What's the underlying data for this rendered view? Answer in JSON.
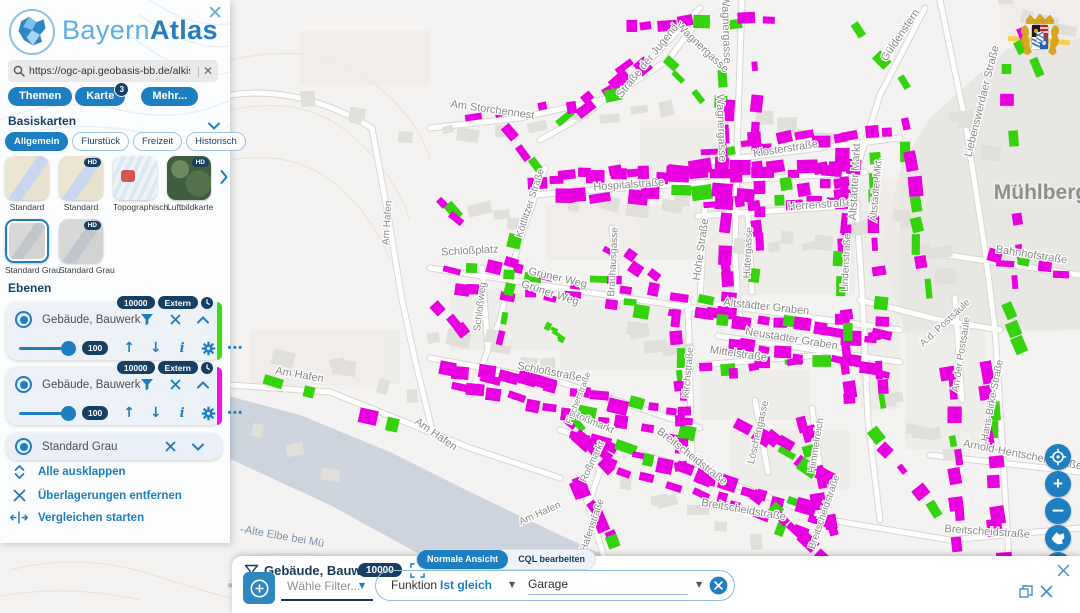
{
  "sidebar": {
    "close_icon": "✕",
    "logo": {
      "part1": "Bayern",
      "part2": "Atlas"
    },
    "search": {
      "value": "https://ogc-api.geobasis-bb.de/alkis-verein",
      "clear": "✕"
    },
    "menu": [
      {
        "label": "Themen"
      },
      {
        "label": "Karte",
        "badge": "3"
      },
      {
        "label": "Mehr..."
      }
    ],
    "basiskarten": {
      "header": "Basiskarten",
      "hd_label": "HD",
      "tabs": [
        {
          "label": "Allgemein",
          "active": true
        },
        {
          "label": "Flurstück",
          "active": false
        },
        {
          "label": "Freizeit",
          "active": false
        },
        {
          "label": "Historisch",
          "active": false
        }
      ],
      "thumbs": [
        {
          "label": "Standard",
          "style": "std",
          "hd": false,
          "selected": false
        },
        {
          "label": "Standard",
          "style": "std",
          "hd": true,
          "selected": false
        },
        {
          "label": "Topographisch",
          "style": "topo",
          "hd": false,
          "selected": false
        },
        {
          "label": "Luftbildkarte",
          "style": "aerial",
          "hd": true,
          "selected": false
        },
        {
          "label": "Standard Grau",
          "style": "gray",
          "hd": false,
          "selected": true
        },
        {
          "label": "Standard Grau",
          "style": "gray",
          "hd": true,
          "selected": false
        }
      ]
    },
    "ebenen": {
      "header": "Ebenen",
      "cards": [
        {
          "title": "Gebäude, Bauwerk",
          "badges": [
            "10000",
            "Extern"
          ],
          "opacity": "100",
          "stripe": "#3edc12",
          "expanded": true
        },
        {
          "title": "Gebäude, Bauwerk",
          "badges": [
            "10000",
            "Extern"
          ],
          "opacity": "100",
          "stripe": "#f013e4",
          "expanded": true
        },
        {
          "title": "Standard Grau",
          "badges": [],
          "opacity": "",
          "stripe": "",
          "expanded": false
        }
      ]
    },
    "actions": [
      {
        "icon": "expand",
        "label": "Alle ausklappen"
      },
      {
        "icon": "remove",
        "label": "Überlagerungen entfernen"
      },
      {
        "icon": "compare",
        "label": "Vergleichen starten"
      }
    ]
  },
  "filter": {
    "title": "Gebäude, Bauwerk",
    "badge": "10000",
    "views": [
      {
        "label": "Normale Ansicht",
        "active": true
      },
      {
        "label": "CQL bearbeiten",
        "active": false
      }
    ],
    "choose": "Wähle Filter...",
    "attribute": "Funktion",
    "operator": "Ist gleich",
    "value": "Garage"
  },
  "map": {
    "region_label": "Mühlberg",
    "water_label": "Alte Elbe bei Mü",
    "water_arrow": "←",
    "controls": {
      "zoom_in": "+",
      "zoom_out": "−",
      "threed": "3D"
    },
    "colors": {
      "magenta": "#e900e1",
      "green": "#35d30e"
    },
    "street_labels": [
      {
        "t": "Wagnergasse",
        "x": 700,
        "y": 50,
        "r": 43,
        "s": 11
      },
      {
        "t": "Wagnergasse",
        "x": 723,
        "y": 30,
        "r": 88,
        "s": 11
      },
      {
        "t": "Wagnergasse",
        "x": 718,
        "y": 128,
        "r": 88,
        "s": 11
      },
      {
        "t": "Straße der Jugend",
        "x": 650,
        "y": 63,
        "r": -51,
        "s": 11
      },
      {
        "t": "Am Storchennest",
        "x": 492,
        "y": 113,
        "r": 8,
        "s": 11
      },
      {
        "t": "Güldenstern",
        "x": 903,
        "y": 37,
        "r": -56,
        "s": 11
      },
      {
        "t": "Klosterstraße",
        "x": 786,
        "y": 152,
        "r": -9,
        "s": 11
      },
      {
        "t": "Hospitalstraße",
        "x": 629,
        "y": 188,
        "r": -4,
        "s": 11
      },
      {
        "t": "Herrenstraße",
        "x": 820,
        "y": 208,
        "r": -4,
        "s": 11
      },
      {
        "t": "Altstädter Markt",
        "x": 858,
        "y": 182,
        "r": -87,
        "s": 11
      },
      {
        "t": "Altstädter Mkt.",
        "x": 879,
        "y": 190,
        "r": -85,
        "s": 10
      },
      {
        "t": "Hohe Straße",
        "x": 704,
        "y": 250,
        "r": -82,
        "s": 11
      },
      {
        "t": "Hütergasse",
        "x": 751,
        "y": 253,
        "r": -87,
        "s": 10
      },
      {
        "t": "Köttlitzer Straße",
        "x": 533,
        "y": 204,
        "r": -72,
        "s": 10
      },
      {
        "t": "Liebenswerdaer Straße",
        "x": 985,
        "y": 102,
        "r": -76,
        "s": 11
      },
      {
        "t": "Bahnhofstraße",
        "x": 1031,
        "y": 258,
        "r": 9,
        "s": 11
      },
      {
        "t": "Schloßplatz",
        "x": 470,
        "y": 254,
        "r": -3,
        "s": 11
      },
      {
        "t": "Grüner Weg",
        "x": 557,
        "y": 281,
        "r": 13,
        "s": 11
      },
      {
        "t": "Grüner Weg",
        "x": 549,
        "y": 296,
        "r": 18,
        "s": 11
      },
      {
        "t": "Schloßweg",
        "x": 483,
        "y": 307,
        "r": -83,
        "s": 10
      },
      {
        "t": "Brauhausgasse",
        "x": 616,
        "y": 262,
        "r": -87,
        "s": 10
      },
      {
        "t": "Altstädter Graben",
        "x": 766,
        "y": 310,
        "r": 6,
        "s": 11
      },
      {
        "t": "Neustädter Graben",
        "x": 791,
        "y": 342,
        "r": 9,
        "s": 11
      },
      {
        "t": "Mittelstraße",
        "x": 738,
        "y": 357,
        "r": 8,
        "s": 11
      },
      {
        "t": "Kirchstraße",
        "x": 691,
        "y": 373,
        "r": -85,
        "s": 10
      },
      {
        "t": "Schloßstraße",
        "x": 549,
        "y": 375,
        "r": 11,
        "s": 11
      },
      {
        "t": "Lindenstraße",
        "x": 849,
        "y": 263,
        "r": -87,
        "s": 10
      },
      {
        "t": "A.d. Postsäule",
        "x": 947,
        "y": 325,
        "r": -43,
        "s": 10
      },
      {
        "t": "An der Postsäule",
        "x": 964,
        "y": 355,
        "r": -81,
        "s": 10
      },
      {
        "t": "Hans-Birke-Straße",
        "x": 995,
        "y": 401,
        "r": -79,
        "s": 10
      },
      {
        "t": "Arnold-Hentschel-Straße",
        "x": 1022,
        "y": 458,
        "r": 11,
        "s": 11
      },
      {
        "t": "Breitscheidstraße",
        "x": 690,
        "y": 459,
        "r": 38,
        "s": 11
      },
      {
        "t": "Breitscheidstraße",
        "x": 743,
        "y": 513,
        "r": 10,
        "s": 11
      },
      {
        "t": "Breitscheidstraße",
        "x": 827,
        "y": 513,
        "r": -71,
        "s": 10
      },
      {
        "t": "Breitscheidstraße",
        "x": 987,
        "y": 535,
        "r": 4,
        "s": 11
      },
      {
        "t": "Löschengasse",
        "x": 761,
        "y": 433,
        "r": -77,
        "s": 10
      },
      {
        "t": "Himmelreich",
        "x": 819,
        "y": 446,
        "r": -81,
        "s": 10
      },
      {
        "t": "Roßmarkt",
        "x": 592,
        "y": 425,
        "r": 23,
        "s": 10
      },
      {
        "t": "Roßmarkt",
        "x": 595,
        "y": 463,
        "r": -65,
        "s": 10
      },
      {
        "t": "Fischerstraße",
        "x": 581,
        "y": 399,
        "r": -69,
        "s": 9
      },
      {
        "t": "Hafenstraße",
        "x": 595,
        "y": 526,
        "r": -71,
        "s": 10
      },
      {
        "t": "Am Hafen",
        "x": 390,
        "y": 223,
        "r": -86,
        "s": 10
      },
      {
        "t": "Am Hafen",
        "x": 299,
        "y": 378,
        "r": 10,
        "s": 11
      },
      {
        "t": "Am Hafen",
        "x": 434,
        "y": 437,
        "r": 35,
        "s": 11
      },
      {
        "t": "Am Hafen",
        "x": 541,
        "y": 516,
        "r": -24,
        "s": 10
      }
    ],
    "building_rows": [
      [
        540,
        178,
        862,
        166,
        26,
        13,
        0.14
      ],
      [
        546,
        197,
        858,
        187,
        13,
        12,
        0.2
      ],
      [
        700,
        151,
        893,
        130,
        12,
        11,
        0.12
      ],
      [
        703,
        207,
        851,
        198,
        9,
        11,
        0.15
      ],
      [
        724,
        72,
        727,
        290,
        12,
        12,
        0.15
      ],
      [
        754,
        64,
        757,
        285,
        10,
        11,
        0.2
      ],
      [
        628,
        26,
        772,
        18,
        8,
        11,
        0.22
      ],
      [
        560,
        120,
        648,
        58,
        7,
        12,
        0.2
      ],
      [
        440,
        264,
        730,
        300,
        14,
        11,
        0.14
      ],
      [
        448,
        284,
        733,
        318,
        12,
        11,
        0.2
      ],
      [
        700,
        312,
        894,
        340,
        12,
        12,
        0.12
      ],
      [
        722,
        347,
        894,
        370,
        10,
        11,
        0.2
      ],
      [
        702,
        372,
        808,
        363,
        7,
        10,
        0.15
      ],
      [
        440,
        364,
        690,
        418,
        16,
        12,
        0.12
      ],
      [
        448,
        385,
        692,
        439,
        13,
        12,
        0.2
      ],
      [
        679,
        312,
        684,
        468,
        10,
        11,
        0.25
      ],
      [
        572,
        434,
        828,
        518,
        17,
        12,
        0.12
      ],
      [
        592,
        457,
        818,
        537,
        10,
        11,
        0.25
      ],
      [
        840,
        153,
        850,
        418,
        15,
        12,
        0.15
      ],
      [
        872,
        151,
        881,
        415,
        12,
        11,
        0.2
      ],
      [
        905,
        113,
        925,
        298,
        9,
        12,
        0.25
      ],
      [
        1006,
        63,
        1019,
        298,
        7,
        11,
        0.3
      ],
      [
        950,
        363,
        961,
        558,
        9,
        12,
        0.2
      ],
      [
        986,
        353,
        1001,
        558,
        10,
        13,
        0.18
      ],
      [
        986,
        257,
        1068,
        272,
        5,
        11,
        0.2
      ],
      [
        740,
        421,
        828,
        478,
        8,
        12,
        0.15
      ],
      [
        803,
        418,
        831,
        540,
        8,
        12,
        0.2
      ],
      [
        250,
        372,
        420,
        432,
        4,
        12,
        0.3
      ],
      [
        572,
        470,
        619,
        558,
        6,
        12,
        0.2
      ],
      [
        566,
        416,
        618,
        470,
        6,
        12,
        0.1
      ],
      [
        519,
        232,
        497,
        348,
        6,
        11,
        0.35
      ],
      [
        452,
        122,
        638,
        93,
        5,
        10,
        0.5
      ],
      [
        436,
        300,
        469,
        340,
        3,
        11,
        0.3
      ],
      [
        1040,
        578,
        1074,
        600,
        2,
        11,
        0.5
      ],
      [
        549,
        328,
        566,
        337,
        5,
        7,
        1
      ],
      [
        848,
        18,
        906,
        95,
        3,
        11,
        0.8
      ],
      [
        660,
        50,
        700,
        96,
        3,
        10,
        0.6
      ],
      [
        600,
        240,
        660,
        281,
        4,
        11,
        0.2
      ],
      [
        508,
        130,
        540,
        170,
        3,
        11,
        0.2
      ],
      [
        432,
        190,
        470,
        230,
        3,
        12,
        0.1
      ],
      [
        750,
        490,
        830,
        560,
        6,
        12,
        0.15
      ],
      [
        870,
        430,
        940,
        520,
        5,
        12,
        0.2
      ],
      [
        630,
        555,
        710,
        600,
        4,
        12,
        0.4
      ],
      [
        1012,
        15,
        1040,
        90,
        3,
        11,
        0.6
      ],
      [
        1008,
        300,
        1028,
        360,
        3,
        11,
        0.6
      ]
    ]
  }
}
